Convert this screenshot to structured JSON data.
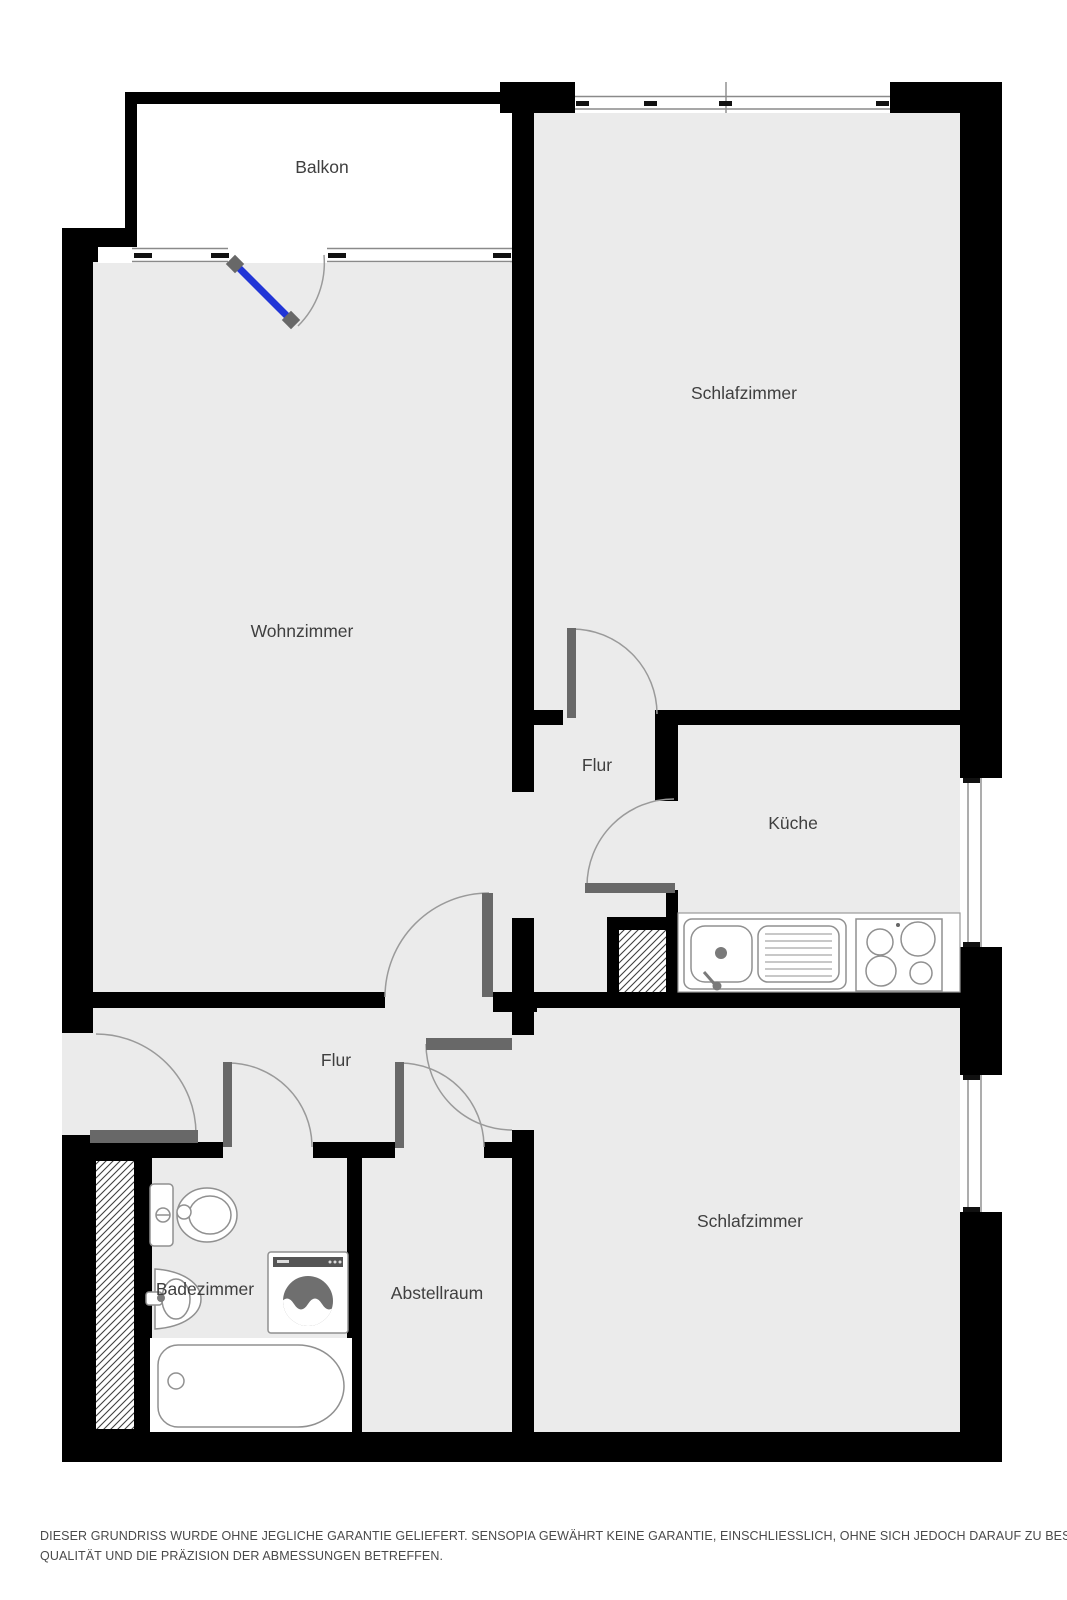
{
  "rooms": [
    {
      "id": "balkon",
      "label": "Balkon"
    },
    {
      "id": "schlafzimmer-1",
      "label": "Schlafzimmer"
    },
    {
      "id": "wohnzimmer",
      "label": "Wohnzimmer"
    },
    {
      "id": "flur-1",
      "label": "Flur"
    },
    {
      "id": "kueche",
      "label": "Küche"
    },
    {
      "id": "flur-2",
      "label": "Flur"
    },
    {
      "id": "badezimmer",
      "label": "Badezimmer"
    },
    {
      "id": "abstellraum",
      "label": "Abstellraum"
    },
    {
      "id": "schlafzimmer-2",
      "label": "Schlafzimmer"
    }
  ],
  "disclaimer": {
    "line1": "DIESER GRUNDRISS WURDE OHNE JEGLICHE GARANTIE GELIEFERT. SENSOPIA GEWÄHRT KEINE GARANTIE, EINSCHLIESSLICH, OHNE SICH JEDOCH DARAUF ZU BESCHRÄNKEN, GARANTIEN, DIE DIE",
    "line2": "QUALITÄT UND DIE PRÄZISION DER ABMESSUNGEN BETREFFEN."
  },
  "colors": {
    "wall": "#000000",
    "floor": "#ebebeb",
    "balcony_door_blue": "#2135d6",
    "door_gray": "#686868"
  }
}
